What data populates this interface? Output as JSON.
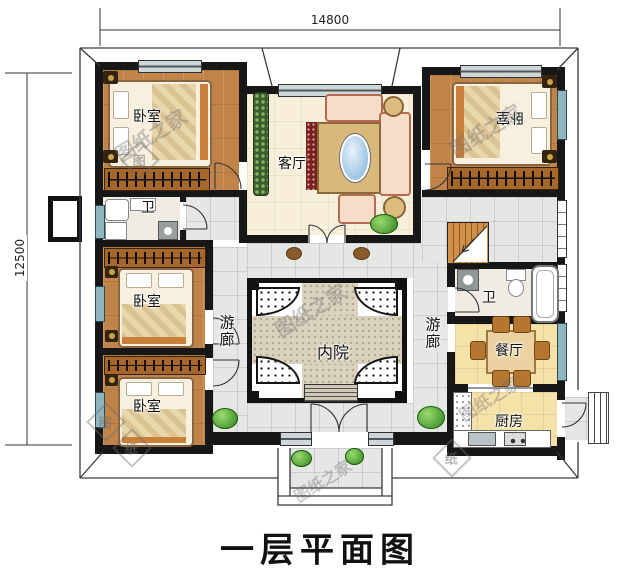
{
  "title": "一层平面图",
  "watermark": {
    "text": "图纸之家",
    "stamp_char_1": "图",
    "stamp_char_2": "纸"
  },
  "dimensions": {
    "top": "14800",
    "left": "12500"
  },
  "rooms": {
    "bedroom_top_left": {
      "label": "卧室"
    },
    "bedroom_top_right": {
      "label": "卧室"
    },
    "bedroom_mid_left": {
      "label": "卧室"
    },
    "bedroom_bottom_left": {
      "label": "卧室"
    },
    "living_room": {
      "label": "客厅"
    },
    "bathroom_left": {
      "label": "卫"
    },
    "bathroom_right": {
      "label": "卫"
    },
    "veranda_left": {
      "label": "游廊"
    },
    "veranda_right": {
      "label": "游廊"
    },
    "courtyard": {
      "label": "内院"
    },
    "dining_room": {
      "label": "餐厅"
    },
    "kitchen": {
      "label": "厨房"
    }
  },
  "colors": {
    "wall": "#171717",
    "wood_floor": "#c08448",
    "tile": "#e5e7e5",
    "living_floor": "#f7efda",
    "yellow_floor": "#f5e2a9",
    "pebble": "#d9d2bf",
    "window_teal": "#8fb6bc",
    "stairs": "#c98844",
    "plant_green": "#55a33a",
    "table_blue": "#9cc4e6"
  }
}
